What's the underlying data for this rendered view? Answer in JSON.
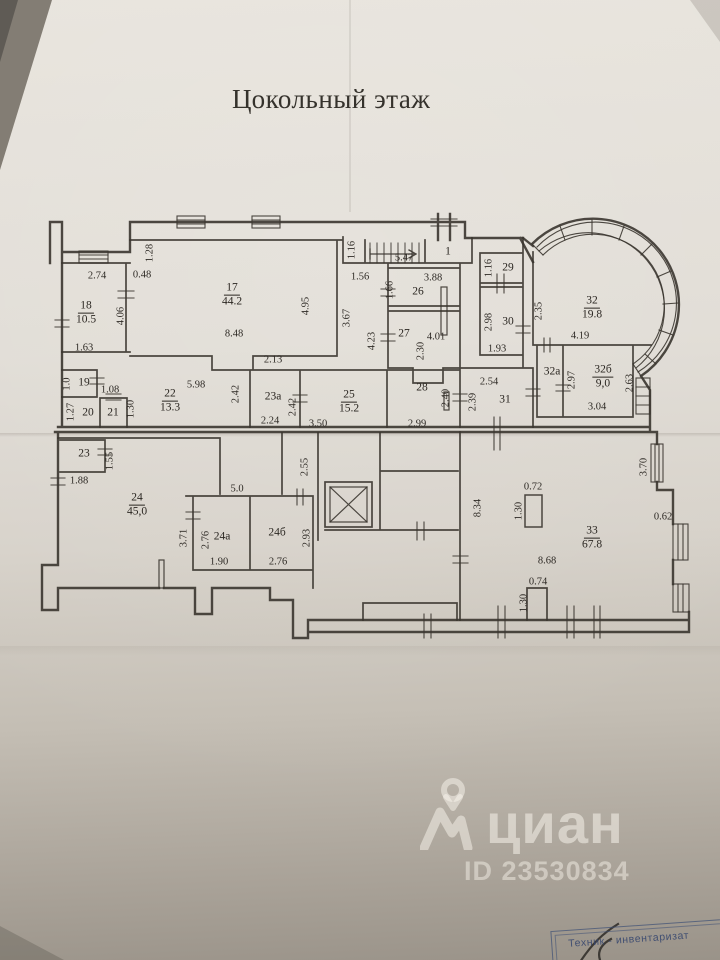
{
  "title": "Цокольный этаж",
  "watermark": {
    "brand": "циан",
    "id_label": "ID 23530834"
  },
  "stamp": {
    "text": "Техник - инвентаризат"
  },
  "colors": {
    "ink": "#3a352f",
    "stamp_blue": "#3e5076",
    "paper_light": "#e8e4dd",
    "paper_dark": "#9a9389",
    "watermark": "rgba(250,246,238,0.52)"
  },
  "plan": {
    "rooms": [
      {
        "n": "17",
        "a": "44.2",
        "x": 232,
        "y": 295
      },
      {
        "n": "18",
        "a": "10.5",
        "x": 86,
        "y": 313
      },
      {
        "n": "1",
        "x": 448,
        "y": 252
      },
      {
        "n": "26",
        "x": 418,
        "y": 292
      },
      {
        "n": "27",
        "x": 404,
        "y": 334
      },
      {
        "n": "29",
        "x": 508,
        "y": 268
      },
      {
        "n": "30",
        "x": 508,
        "y": 322
      },
      {
        "n": "32",
        "a": "19.8",
        "x": 592,
        "y": 308
      },
      {
        "n": "32а",
        "x": 552,
        "y": 372
      },
      {
        "n": "32б",
        "a": "9,0",
        "x": 603,
        "y": 377
      },
      {
        "n": "31",
        "x": 505,
        "y": 400
      },
      {
        "n": "28",
        "x": 422,
        "y": 388
      },
      {
        "n": "25",
        "a": "15.2",
        "x": 349,
        "y": 402
      },
      {
        "n": "23а",
        "x": 273,
        "y": 397
      },
      {
        "n": "22",
        "a": "13.3",
        "x": 170,
        "y": 401
      },
      {
        "n": "19",
        "x": 84,
        "y": 383
      },
      {
        "n": "20",
        "x": 88,
        "y": 413
      },
      {
        "n": "21",
        "x": 113,
        "y": 413
      },
      {
        "n": "23",
        "x": 84,
        "y": 454
      },
      {
        "n": "24",
        "a": "45,0",
        "x": 137,
        "y": 505
      },
      {
        "n": "24а",
        "x": 222,
        "y": 537
      },
      {
        "n": "24б",
        "x": 277,
        "y": 533
      },
      {
        "n": "33",
        "a": "67.8",
        "x": 592,
        "y": 538
      }
    ],
    "dims": [
      {
        "t": "2.74",
        "x": 97,
        "y": 276
      },
      {
        "t": "0.48",
        "x": 142,
        "y": 275
      },
      {
        "t": "1.28",
        "x": 150,
        "y": 253,
        "v": true
      },
      {
        "t": "4.06",
        "x": 121,
        "y": 316,
        "v": true
      },
      {
        "t": "1.63",
        "x": 84,
        "y": 348
      },
      {
        "t": "8.48",
        "x": 234,
        "y": 334
      },
      {
        "t": "4.95",
        "x": 306,
        "y": 306,
        "v": true
      },
      {
        "t": "2.13",
        "x": 273,
        "y": 360
      },
      {
        "t": "1.16",
        "x": 352,
        "y": 250,
        "v": true
      },
      {
        "t": "5.47",
        "x": 404,
        "y": 258
      },
      {
        "t": "1.56",
        "x": 360,
        "y": 277
      },
      {
        "t": "3.88",
        "x": 433,
        "y": 278
      },
      {
        "t": "1.66",
        "x": 390,
        "y": 290,
        "v": true
      },
      {
        "t": "3.67",
        "x": 347,
        "y": 318,
        "v": true
      },
      {
        "t": "4.23",
        "x": 372,
        "y": 341,
        "v": true
      },
      {
        "t": "4.01",
        "x": 436,
        "y": 337
      },
      {
        "t": "2.30",
        "x": 421,
        "y": 351,
        "v": true
      },
      {
        "t": "1.16",
        "x": 489,
        "y": 268,
        "v": true
      },
      {
        "t": "2.98",
        "x": 489,
        "y": 322,
        "v": true
      },
      {
        "t": "1.93",
        "x": 497,
        "y": 349
      },
      {
        "t": "2.35",
        "x": 539,
        "y": 311,
        "v": true
      },
      {
        "t": "4.19",
        "x": 580,
        "y": 336
      },
      {
        "t": "2.54",
        "x": 489,
        "y": 382
      },
      {
        "t": "2.39",
        "x": 473,
        "y": 402,
        "v": true
      },
      {
        "t": "2.97",
        "x": 572,
        "y": 380,
        "v": true
      },
      {
        "t": "2.63",
        "x": 630,
        "y": 383,
        "v": true
      },
      {
        "t": "3.04",
        "x": 597,
        "y": 407
      },
      {
        "t": "5.98",
        "x": 196,
        "y": 385
      },
      {
        "t": "2.42",
        "x": 236,
        "y": 394,
        "v": true
      },
      {
        "t": "1.0",
        "x": 67,
        "y": 384,
        "v": true
      },
      {
        "t": "1.08",
        "x": 110,
        "y": 390
      },
      {
        "t": "1.27",
        "x": 71,
        "y": 412,
        "v": true
      },
      {
        "t": "1.30",
        "x": 131,
        "y": 409,
        "v": true
      },
      {
        "t": "2.24",
        "x": 270,
        "y": 421
      },
      {
        "t": "2.42",
        "x": 293,
        "y": 407,
        "v": true
      },
      {
        "t": "3.50",
        "x": 318,
        "y": 424
      },
      {
        "t": "2.99",
        "x": 417,
        "y": 424
      },
      {
        "t": "2.40",
        "x": 446,
        "y": 398,
        "v": true
      },
      {
        "t": "1.55",
        "x": 110,
        "y": 461,
        "v": true
      },
      {
        "t": "1.88",
        "x": 79,
        "y": 481
      },
      {
        "t": "5.0",
        "x": 237,
        "y": 489
      },
      {
        "t": "3.71",
        "x": 184,
        "y": 538,
        "v": true
      },
      {
        "t": "2.76",
        "x": 206,
        "y": 540,
        "v": true
      },
      {
        "t": "1.90",
        "x": 219,
        "y": 562
      },
      {
        "t": "2.93",
        "x": 307,
        "y": 538,
        "v": true
      },
      {
        "t": "2.76",
        "x": 278,
        "y": 562
      },
      {
        "t": "2.55",
        "x": 305,
        "y": 467,
        "v": true
      },
      {
        "t": "8.34",
        "x": 478,
        "y": 508,
        "v": true
      },
      {
        "t": "0.72",
        "x": 533,
        "y": 487
      },
      {
        "t": "1.30",
        "x": 519,
        "y": 511,
        "v": true
      },
      {
        "t": "8.68",
        "x": 547,
        "y": 561
      },
      {
        "t": "3.70",
        "x": 644,
        "y": 467,
        "v": true
      },
      {
        "t": "0.62",
        "x": 663,
        "y": 517
      },
      {
        "t": "0.74",
        "x": 538,
        "y": 582
      },
      {
        "t": "1.30",
        "x": 524,
        "y": 603,
        "v": true
      }
    ]
  }
}
